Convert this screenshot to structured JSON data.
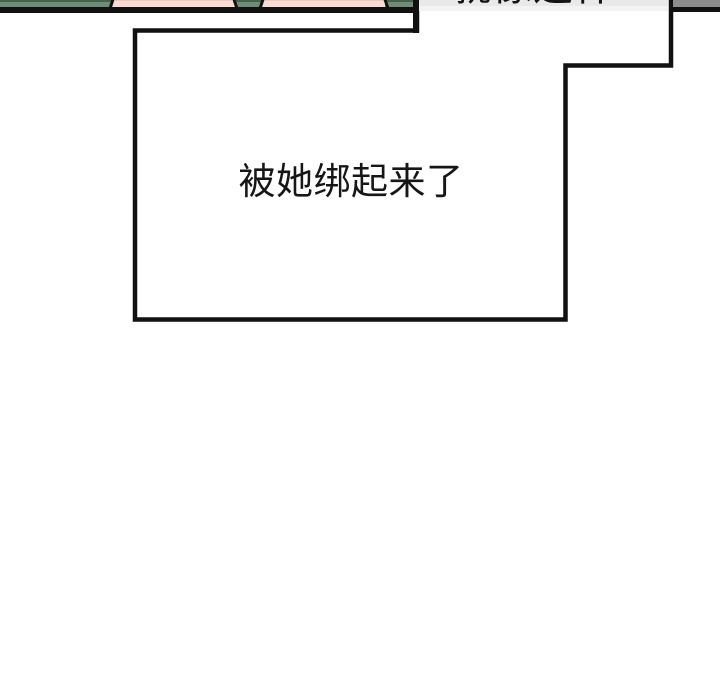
{
  "comic": {
    "caption_text": "被她绑起来了",
    "top_bubble_text": "就像这样…",
    "colors": {
      "page_bg": "#ffffff",
      "outline_black": "#111111",
      "artwork_green": "#6f8c74",
      "artwork_green_dark": "#47624d",
      "artwork_skin": "#f8dcd2",
      "artwork_skin_edge": "#eec8bc",
      "bubble_gray": "#e9e9e9",
      "bubble_gray_light": "#f3f3f3",
      "corner_gray": "#8d8d8d",
      "text_color": "#161616"
    }
  }
}
